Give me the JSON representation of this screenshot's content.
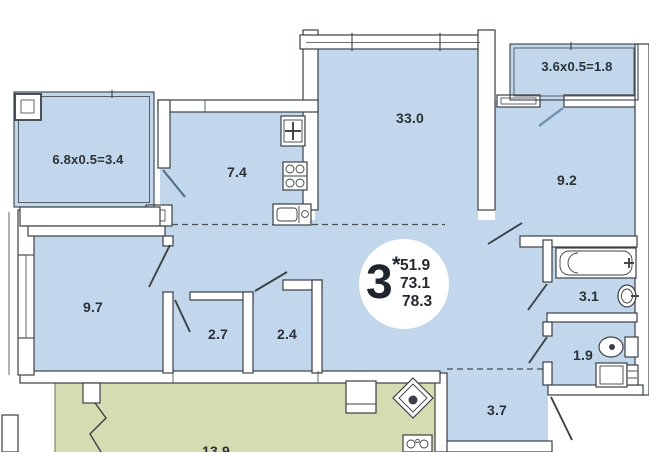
{
  "plan": {
    "badge": {
      "rooms_count": "3",
      "asterisk": "*",
      "areas": [
        "51.9",
        "73.1",
        "78.3"
      ]
    },
    "labels": {
      "balcony_left": "6.8x0.5=3.4",
      "kitchen": "7.4",
      "living": "33.0",
      "balcony_right": "3.6x0.5=1.8",
      "bedroom_right": "9.2",
      "bedroom_left": "9.7",
      "wardrobe_left": "2.7",
      "wardrobe_right": "2.4",
      "bathroom": "3.1",
      "wc": "1.9",
      "hallway": "3.7",
      "neighbor_room": "13.9"
    },
    "colors": {
      "apartment_fill": "#c2d7eb",
      "neighbor_fill": "#d5dcb2",
      "wall_stroke": "#3a4046",
      "label_text": "#2a3138",
      "balcony_door": "#6f93b0",
      "badge_fill": "#ffffff"
    }
  }
}
